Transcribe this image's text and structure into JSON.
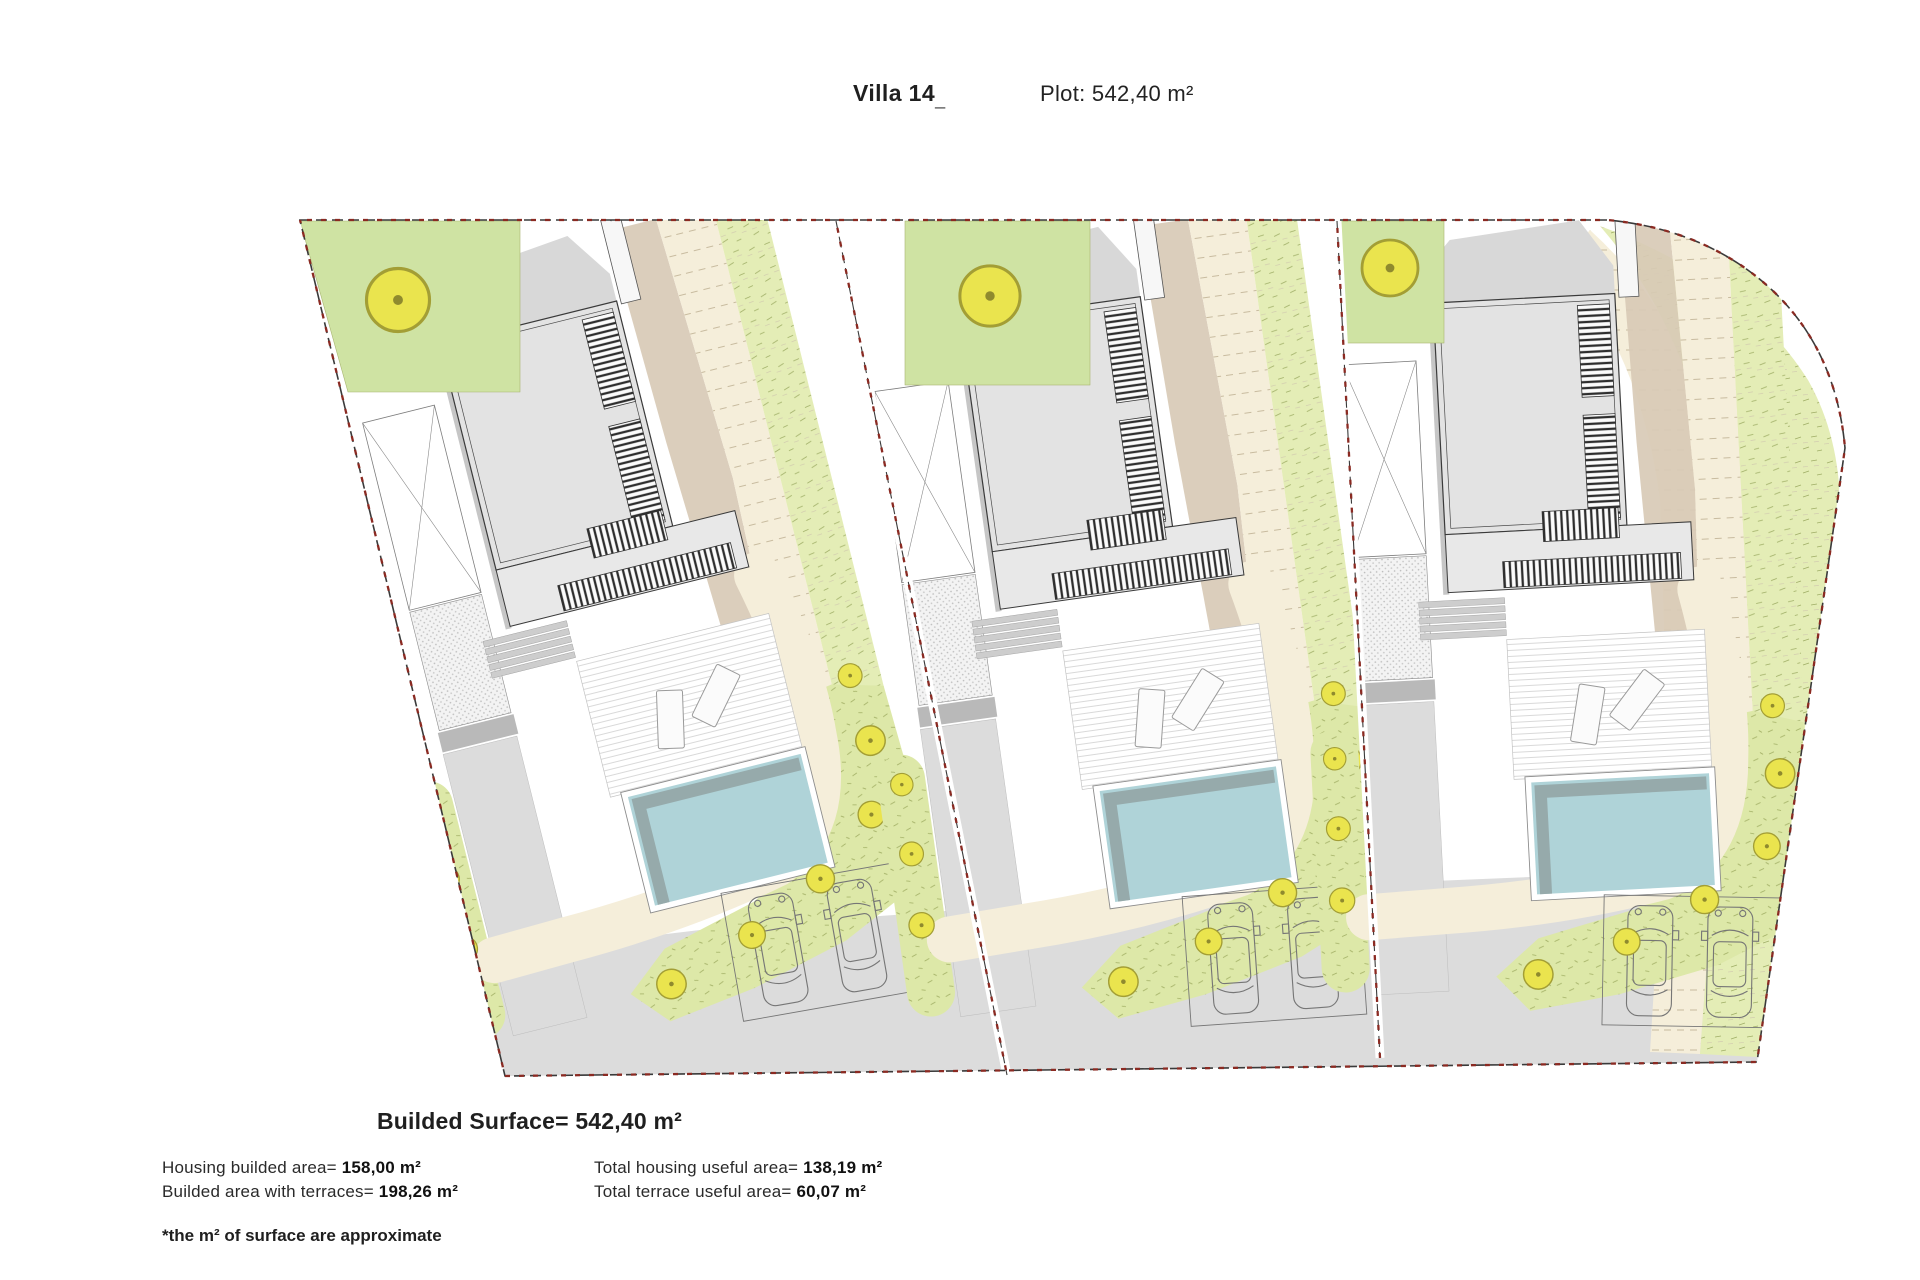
{
  "header": {
    "title": "Villa 14",
    "cursor_mark": "_",
    "plot": "Plot: 542,40 m²"
  },
  "summary": {
    "surface_line": "Builded Surface= 542,40 m²",
    "stats": [
      {
        "label": "Housing builded area= ",
        "value": "158,00 m²"
      },
      {
        "label": "Builded area with terraces= ",
        "value": "198,26 m²"
      },
      {
        "label": "Total housing useful area= ",
        "value": "138,19 m²"
      },
      {
        "label": "Total terrace useful area= ",
        "value": "60,07 m²"
      }
    ],
    "footnote": "*the m² of surface are approximate"
  },
  "plan": {
    "type": "architectural-site-plan",
    "villa_plots": 3,
    "per_villa_elements": {
      "house-roof": 1,
      "roof-louver-bands": 4,
      "entrance-strip": 1,
      "pool": 1,
      "wood-deck": 1,
      "sun-loungers": 2,
      "steps": 5,
      "parking-deck": 1,
      "cars": 2,
      "garden-trees": 10,
      "lawn-areas": 3,
      "slope-bands": 3
    },
    "colors": {
      "lawn": "#dde8a8",
      "lawn-light": "#e4edb6",
      "lawn-bright": "#cfe3a3",
      "grass-mark": "#a3b066",
      "tree-fill": "#eae44e",
      "tree-edge": "#a39e35",
      "pool-water": "#afd3d8",
      "pool-shade": "#96aaab",
      "path-cream": "#f5eeda",
      "slope-tan": "#d8cab6",
      "road-gray": "#dcdcdc",
      "house-gray": "#e3e3e3",
      "house-shadow": "#d8d8d8",
      "boundary-red": "#8b2a22",
      "line-dark": "#3a3a3a",
      "contour": "#b9ab8c",
      "car-line": "#767676"
    }
  }
}
